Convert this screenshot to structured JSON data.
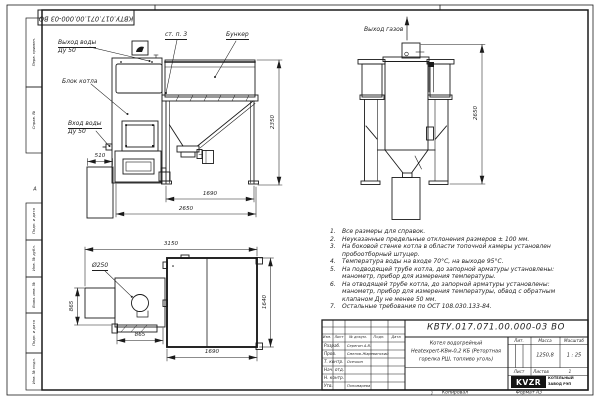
{
  "doc_number": "КВТУ.017.071.00.000-03 ВО",
  "colors": {
    "line": "#1b1b1b",
    "paper": "#ffffff"
  },
  "frame": {
    "zone_letter": "А",
    "left_top": [
      "Перв. примен.",
      "Справ. №"
    ],
    "left_bottom": [
      "Подп. и дата",
      "Инв. № дубл.",
      "Взам. инв. №",
      "Подп. и дата",
      "Инв. № подл."
    ],
    "bottom": {
      "num": "1",
      "copied": "Копировал",
      "format": "Формат А3"
    }
  },
  "front_view": {
    "water_out_line1": "Выход воды",
    "water_out_line2": "Ду 50",
    "boiler_block": "Блок котла",
    "water_in_line1": "Вход воды",
    "water_in_line2": "Ду 50",
    "wall_ref": "ст. п. 3",
    "bunker": "Бункер",
    "dims": {
      "d510": "510",
      "d1690": "1690",
      "d2650": "2650",
      "d2350": "2350"
    }
  },
  "side_view": {
    "gas_out": "Выход газов",
    "dims": {
      "d2650": "2650"
    }
  },
  "top_view": {
    "dims": {
      "d3150": "3150",
      "d250": "Ø250",
      "d865_left": "865",
      "d865_bottom": "865",
      "d1690": "1690",
      "d1640": "1640"
    }
  },
  "notes": [
    {
      "n": "1.",
      "t": "Все размеры для справок."
    },
    {
      "n": "2.",
      "t": "Неуказанные предельные отклонения размеров ± 100 мм."
    },
    {
      "n": "3.",
      "t": "На боковой стенке котла в области топочной камеры установлен пробоотборный штуцер."
    },
    {
      "n": "4.",
      "t": "Температура воды на входе 70°С, на выходе 95°С."
    },
    {
      "n": "5.",
      "t": "На подводящей трубе котла, до запорной арматуры установлены: манометр, прибор для измерения температуры."
    },
    {
      "n": "6.",
      "t": "На отводящей трубе котла, до запорной арматуры установлены: манометр, прибор для измерения температуры, обвод с обратным клапаном Ду не менее 50 мм."
    },
    {
      "n": "7.",
      "t": "Остальные требования по ОСТ 108.030.133-84."
    }
  ],
  "title_block": {
    "number": "КВТУ.017.071.00.000-03 ВО",
    "name_line1": "Котел водогрейный",
    "name_line2": "Heatexpert-КВм-0,2 КБ (Ретортная",
    "name_line3": "горелка РШ, топливо уголь)",
    "cols": {
      "izm": "Изм.",
      "list": "Лист",
      "doc": "№ докум.",
      "podp": "Подп.",
      "data": "Дата"
    },
    "rows": [
      {
        "label": "Разраб.",
        "name": "Серегин А.В."
      },
      {
        "label": "Пров.",
        "name": "Смелов-Жаревинский"
      },
      {
        "label": "Т. контр.",
        "name": "Осечкин"
      },
      {
        "label": "Нач. отд.",
        "name": ""
      },
      {
        "label": "Н. контр.",
        "name": ""
      },
      {
        "label": "Утв.",
        "name": "Пономарева"
      }
    ],
    "lit_label": "Лит.",
    "mass_label": "Масса",
    "scale_label": "Масштаб",
    "mass_value": "1250,8",
    "scale_value": "1 : 25",
    "sheet_label": "Лист",
    "sheets_label": "Листов",
    "sheets_value": "1",
    "logo_text": "KVZR",
    "logo_line1": "КОТЕЛЬНЫЙ",
    "logo_line2": "ЗАВОД РЭП"
  }
}
